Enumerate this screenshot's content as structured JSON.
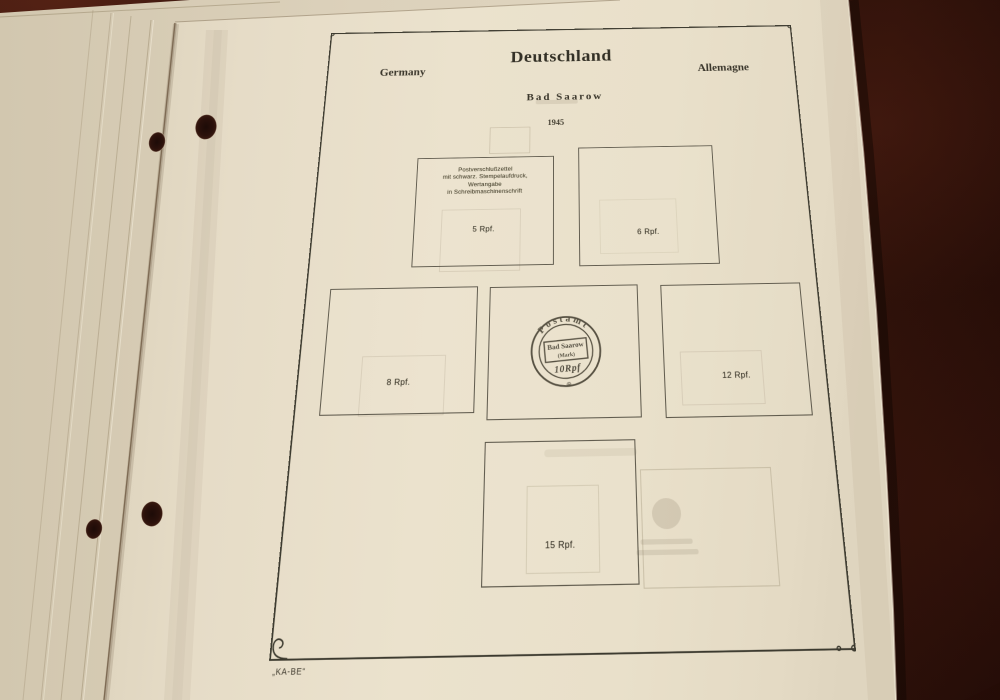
{
  "colors": {
    "background": "#2f110b",
    "paper": "#e8dfca",
    "frame_ink": "#3b392e"
  },
  "album_page": {
    "header": {
      "title": "Deutschland",
      "left_label": "Germany",
      "right_label": "Allemagne",
      "place": "Bad Saarow",
      "year": "1945"
    },
    "publisher_mark": "„KA-BE“",
    "stamp_spaces": [
      {
        "name": "5rpf",
        "description_lines": [
          "Postverschlußzettel",
          "mit schwarz. Stempelaufdruck,",
          "Wertangabe",
          "in Schreibmaschinenschrift"
        ],
        "value": "5 Rpf."
      },
      {
        "name": "6rpf",
        "value": "6 Rpf."
      },
      {
        "name": "8rpf",
        "value": "8 Rpf."
      },
      {
        "name": "10rpf-postmark",
        "postmark": {
          "arc_text": "Postamt",
          "place": "Bad Saarow",
          "region": "(Mark)",
          "value": "10Rpf",
          "bottom_symbol": "⊕"
        }
      },
      {
        "name": "12rpf",
        "value": "12 Rpf."
      },
      {
        "name": "15rpf",
        "value": "15 Rpf."
      }
    ]
  }
}
